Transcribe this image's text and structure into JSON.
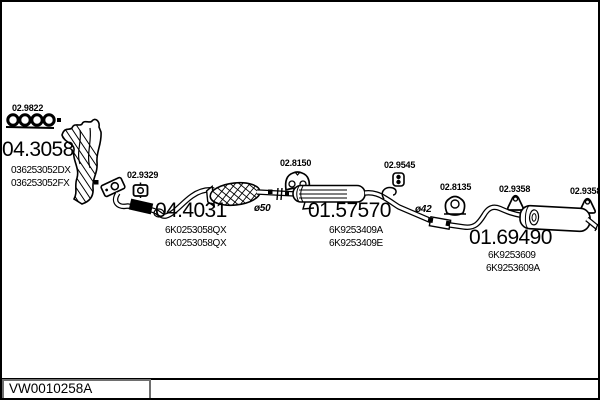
{
  "drawing_code": "VW0010258A",
  "parts": {
    "manifold": {
      "code": "04.3058",
      "oem1": "036253052DX",
      "oem2": "036253052FX",
      "gasket_code": "02.9822"
    },
    "front_pipe": {
      "code": "04.4031",
      "oem1": "6K0253058QX",
      "oem2": "6K0253058QX",
      "gasket_code": "02.9329",
      "diameter": "ø50"
    },
    "center_muffler": {
      "code": "01.57570",
      "oem1": "6K9253409A",
      "oem2": "6K9253409E",
      "hanger_code": "02.8150",
      "clamp_code": "02.9545",
      "diameter": "ø42"
    },
    "rear_muffler": {
      "code": "01.69490",
      "oem1": "6K9253609",
      "oem2": "6K9253609A",
      "hanger_mid_code": "02.8135",
      "hanger1_code": "02.9358",
      "hanger2_code": "02.9358"
    }
  }
}
